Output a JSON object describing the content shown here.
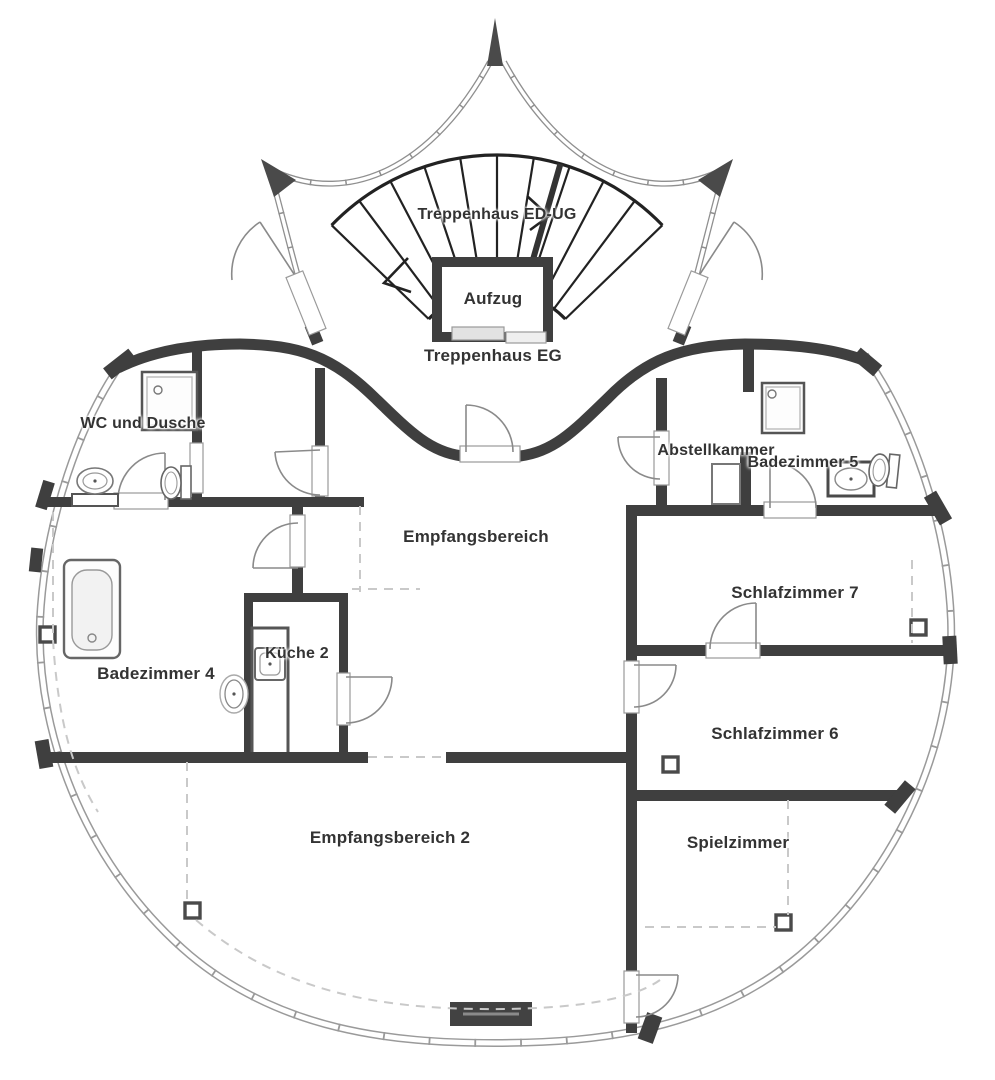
{
  "rooms": [
    {
      "id": "treppenhaus-ed-ug",
      "label": "Treppenhaus ED-UG"
    },
    {
      "id": "aufzug",
      "label": "Aufzug"
    },
    {
      "id": "treppenhaus-eg",
      "label": "Treppenhaus EG"
    },
    {
      "id": "wc-und-dusche",
      "label": "WC und Dusche"
    },
    {
      "id": "abstellkammer",
      "label": "Abstellkammer"
    },
    {
      "id": "badezimmer-5",
      "label": "Badezimmer 5"
    },
    {
      "id": "empfangsbereich",
      "label": "Empfangsbereich"
    },
    {
      "id": "schlafzimmer-7",
      "label": "Schlafzimmer 7"
    },
    {
      "id": "badezimmer-4",
      "label": "Badezimmer 4"
    },
    {
      "id": "kueche-2",
      "label": "Küche 2"
    },
    {
      "id": "schlafzimmer-6",
      "label": "Schlafzimmer 6"
    },
    {
      "id": "empfangsbereich-2",
      "label": "Empfangsbereich 2"
    },
    {
      "id": "spielzimmer",
      "label": "Spielzimmer"
    }
  ],
  "fixtures": [
    "staircase-fan",
    "elevator",
    "entrance-spire",
    "bathtub",
    "shower",
    "wash-basin",
    "toilet",
    "kitchen-sink",
    "storage-cabinet",
    "fireplace",
    "column-marker",
    "door-swing",
    "window-band"
  ],
  "colors": {
    "wall": "#3f3f3f",
    "glazing": "#9a9a9a",
    "dashed_guide": "#c9c9c9",
    "background": "#ffffff",
    "text": "#333333",
    "fixture_dark": "#424242"
  }
}
